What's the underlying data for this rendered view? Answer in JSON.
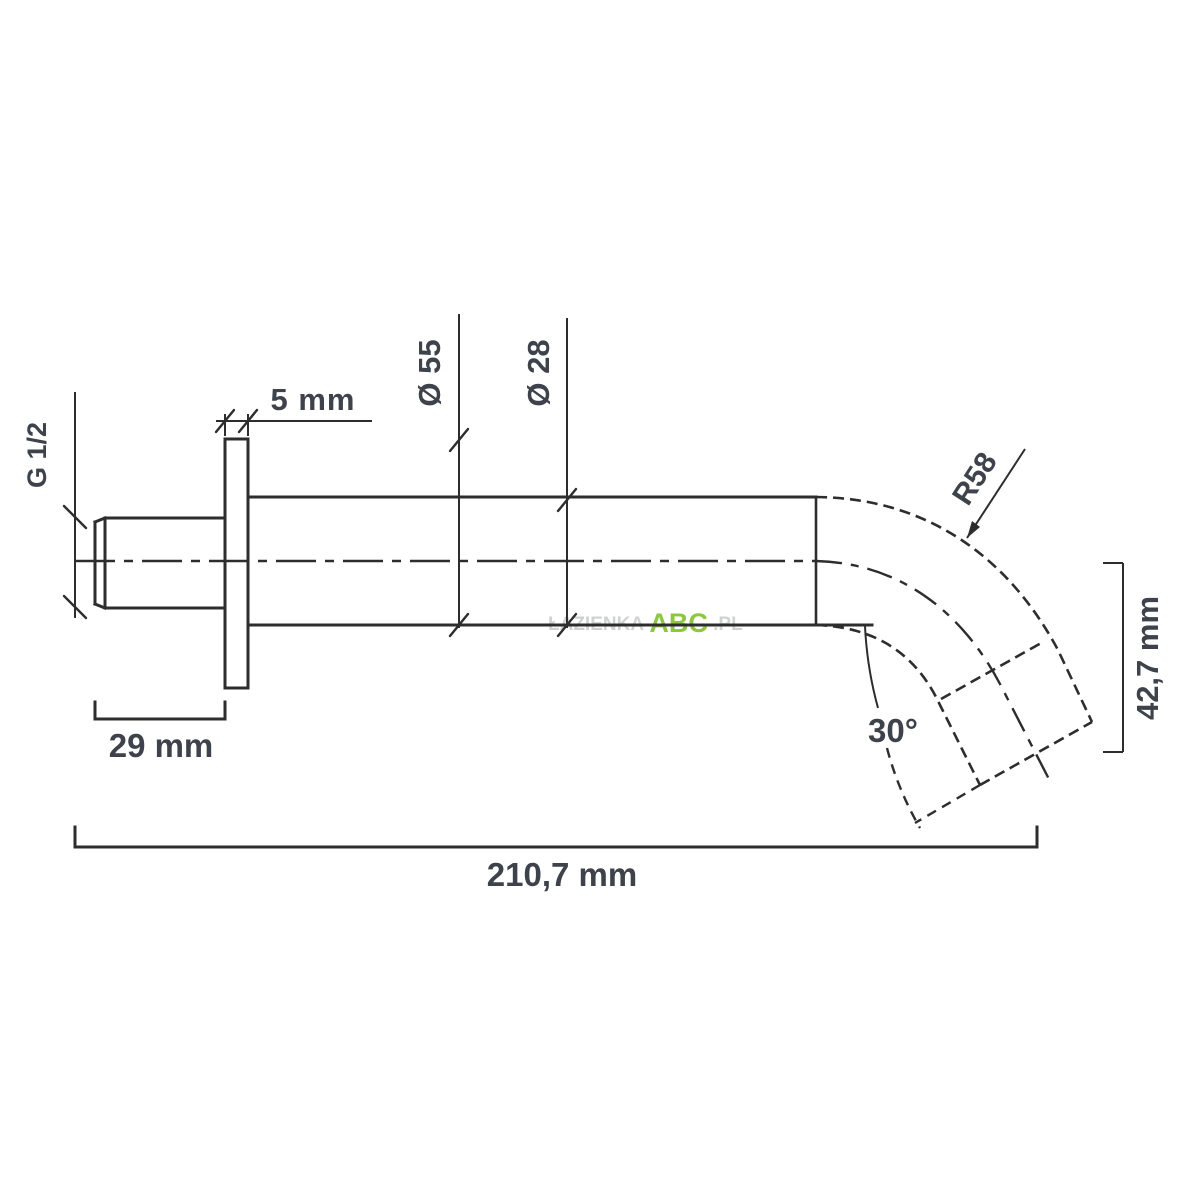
{
  "drawing": {
    "title": "Wall-mounted spout dimensional drawing",
    "labels": {
      "thread": "G 1/2",
      "flange_thickness": "5 mm",
      "flange_diameter": "Ø 55",
      "tube_diameter": "Ø 28",
      "bend_radius": "R58",
      "drop_height": "42,7 mm",
      "spout_angle": "30°",
      "thread_length": "29 mm",
      "total_length": "210,7 mm"
    },
    "watermark": {
      "prefix": "ŁAZIENKA",
      "brand": "ABC",
      "suffix": ".PL",
      "brand_color": "#8dc63f"
    },
    "colors": {
      "line": "#2d2d2d",
      "text": "#3d424b",
      "background": "#ffffff"
    }
  }
}
